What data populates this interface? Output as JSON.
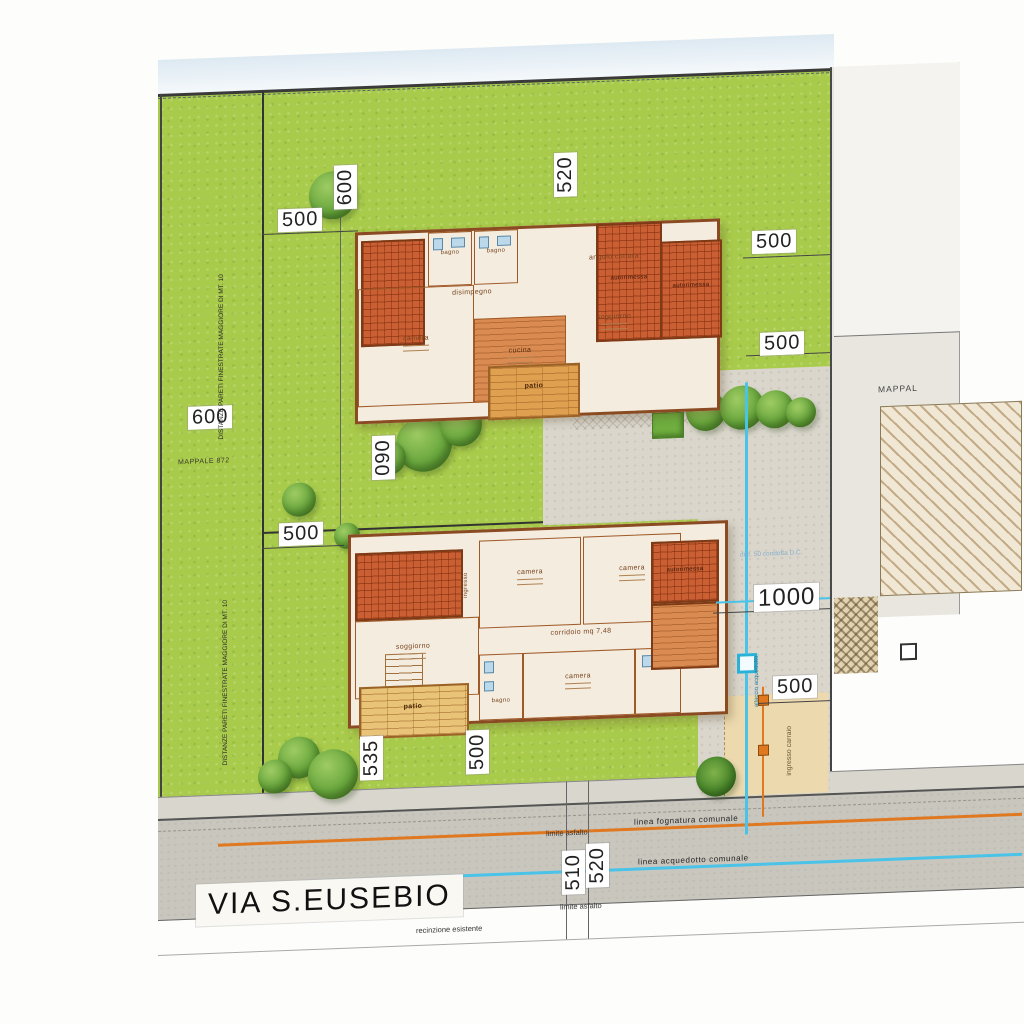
{
  "plan": {
    "street_label": "VIA S.EUSEBIO",
    "parcel_left_note": "DISTANZE PARETI FINESTRATE MAGGIORE DI MT. 10",
    "mappale_left": "MAPPALE 872",
    "mappale_right": "MAPPAL",
    "recinzione": "recinzione esistente",
    "limite_asfalto": "limite asfalto",
    "linea_fognatura": "linea fognatura comunale",
    "linea_acquedotto": "linea acquedotto comunale",
    "ingresso_carraio": "ingresso carraio",
    "allaccio": "allaccio acquedotto",
    "condotta_note": "dist. 50 condotta D.C."
  },
  "dimensions": {
    "lot1_top": "500",
    "lot1_left_v": "600",
    "lot1_mid_v": "520",
    "right_a": "500",
    "right_b": "500",
    "left_mid": "600",
    "mid_v": "090",
    "lot2_top": "500",
    "drive_width": "1000",
    "drive_b": "500",
    "garden_a_v": "535",
    "garden_b_v": "500",
    "road_a_v": "510",
    "road_b_v": "520"
  },
  "house_upper": {
    "rooms": {
      "angolo_cottura": "angolo cottura",
      "soggiorno": "soggiorno",
      "cucina": "cucina",
      "camera": "camera",
      "disimpegno": "disimpegno",
      "bagno_1": "bagno",
      "bagno_2": "bagno",
      "patio": "patio",
      "wing_a": "autorimessa",
      "wing_b": "autorimessa"
    }
  },
  "house_lower": {
    "rooms": {
      "soggiorno": "soggiorno",
      "camera_1": "camera",
      "camera_2": "camera",
      "camera_3": "camera",
      "corridoio": "corridoio mq 7,48",
      "bagno": "bagno",
      "ingresso": "ingresso",
      "autorimessa": "autorimessa",
      "patio": "patio"
    }
  },
  "colors": {
    "lawn": "#a9cb4b",
    "roof": "#c95f33",
    "paving": "#dad6cc",
    "road": "#c9c6be",
    "aqueduct_line": "#49c3e8",
    "sewer_line": "#e07820"
  }
}
